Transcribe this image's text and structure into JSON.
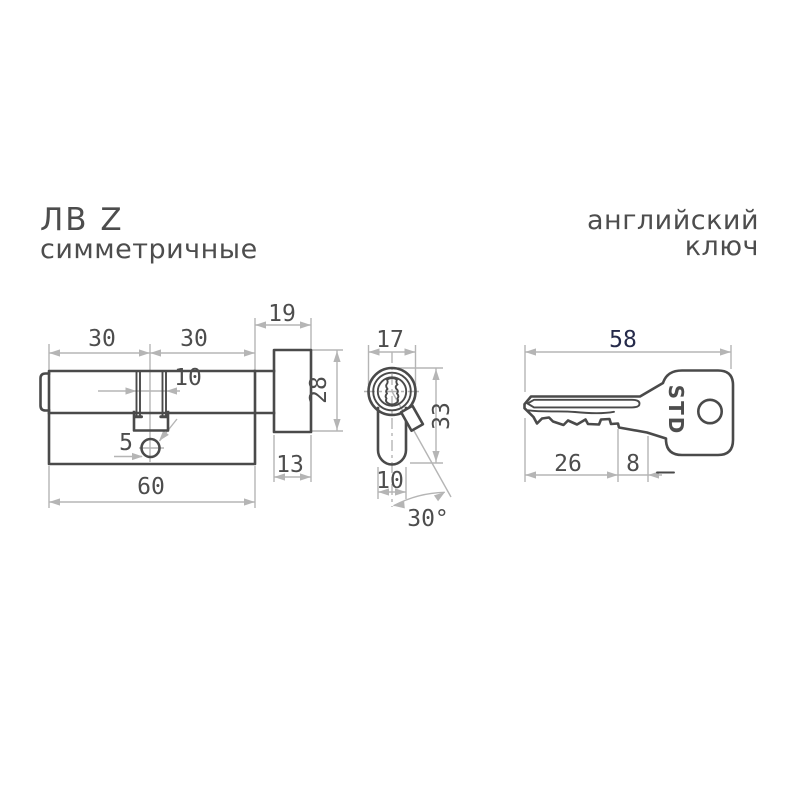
{
  "header": {
    "model": "ЛВ Z",
    "model_subtitle": "симметричные",
    "key_type_line1": "английский",
    "key_type_line2": "ключ"
  },
  "colors": {
    "background": "#ffffff",
    "outline": "#4a4a4a",
    "dimension_lines": "#b5b5b5",
    "dimension_text": "#4d4d4d",
    "total_length_text": "#252a4a"
  },
  "front_view": {
    "description": "cylinder-with-thumbturn-front-view",
    "dimensions": {
      "left_half": "30",
      "right_half": "30",
      "knob_total_depth": "19",
      "cam_slot_width": "10",
      "screw_hole": "5",
      "body_length": "60",
      "knob_depth": "13",
      "knob_diameter": "28"
    }
  },
  "section_view": {
    "description": "cylinder-cross-section",
    "dimensions": {
      "cylinder_diameter": "17",
      "body_height": "33",
      "body_width": "10",
      "cam_angle": "30°"
    }
  },
  "key_view": {
    "description": "english-key",
    "brand": "STD",
    "dimensions": {
      "key_length": "58",
      "blade_length": "26",
      "shoulder": "8"
    }
  }
}
